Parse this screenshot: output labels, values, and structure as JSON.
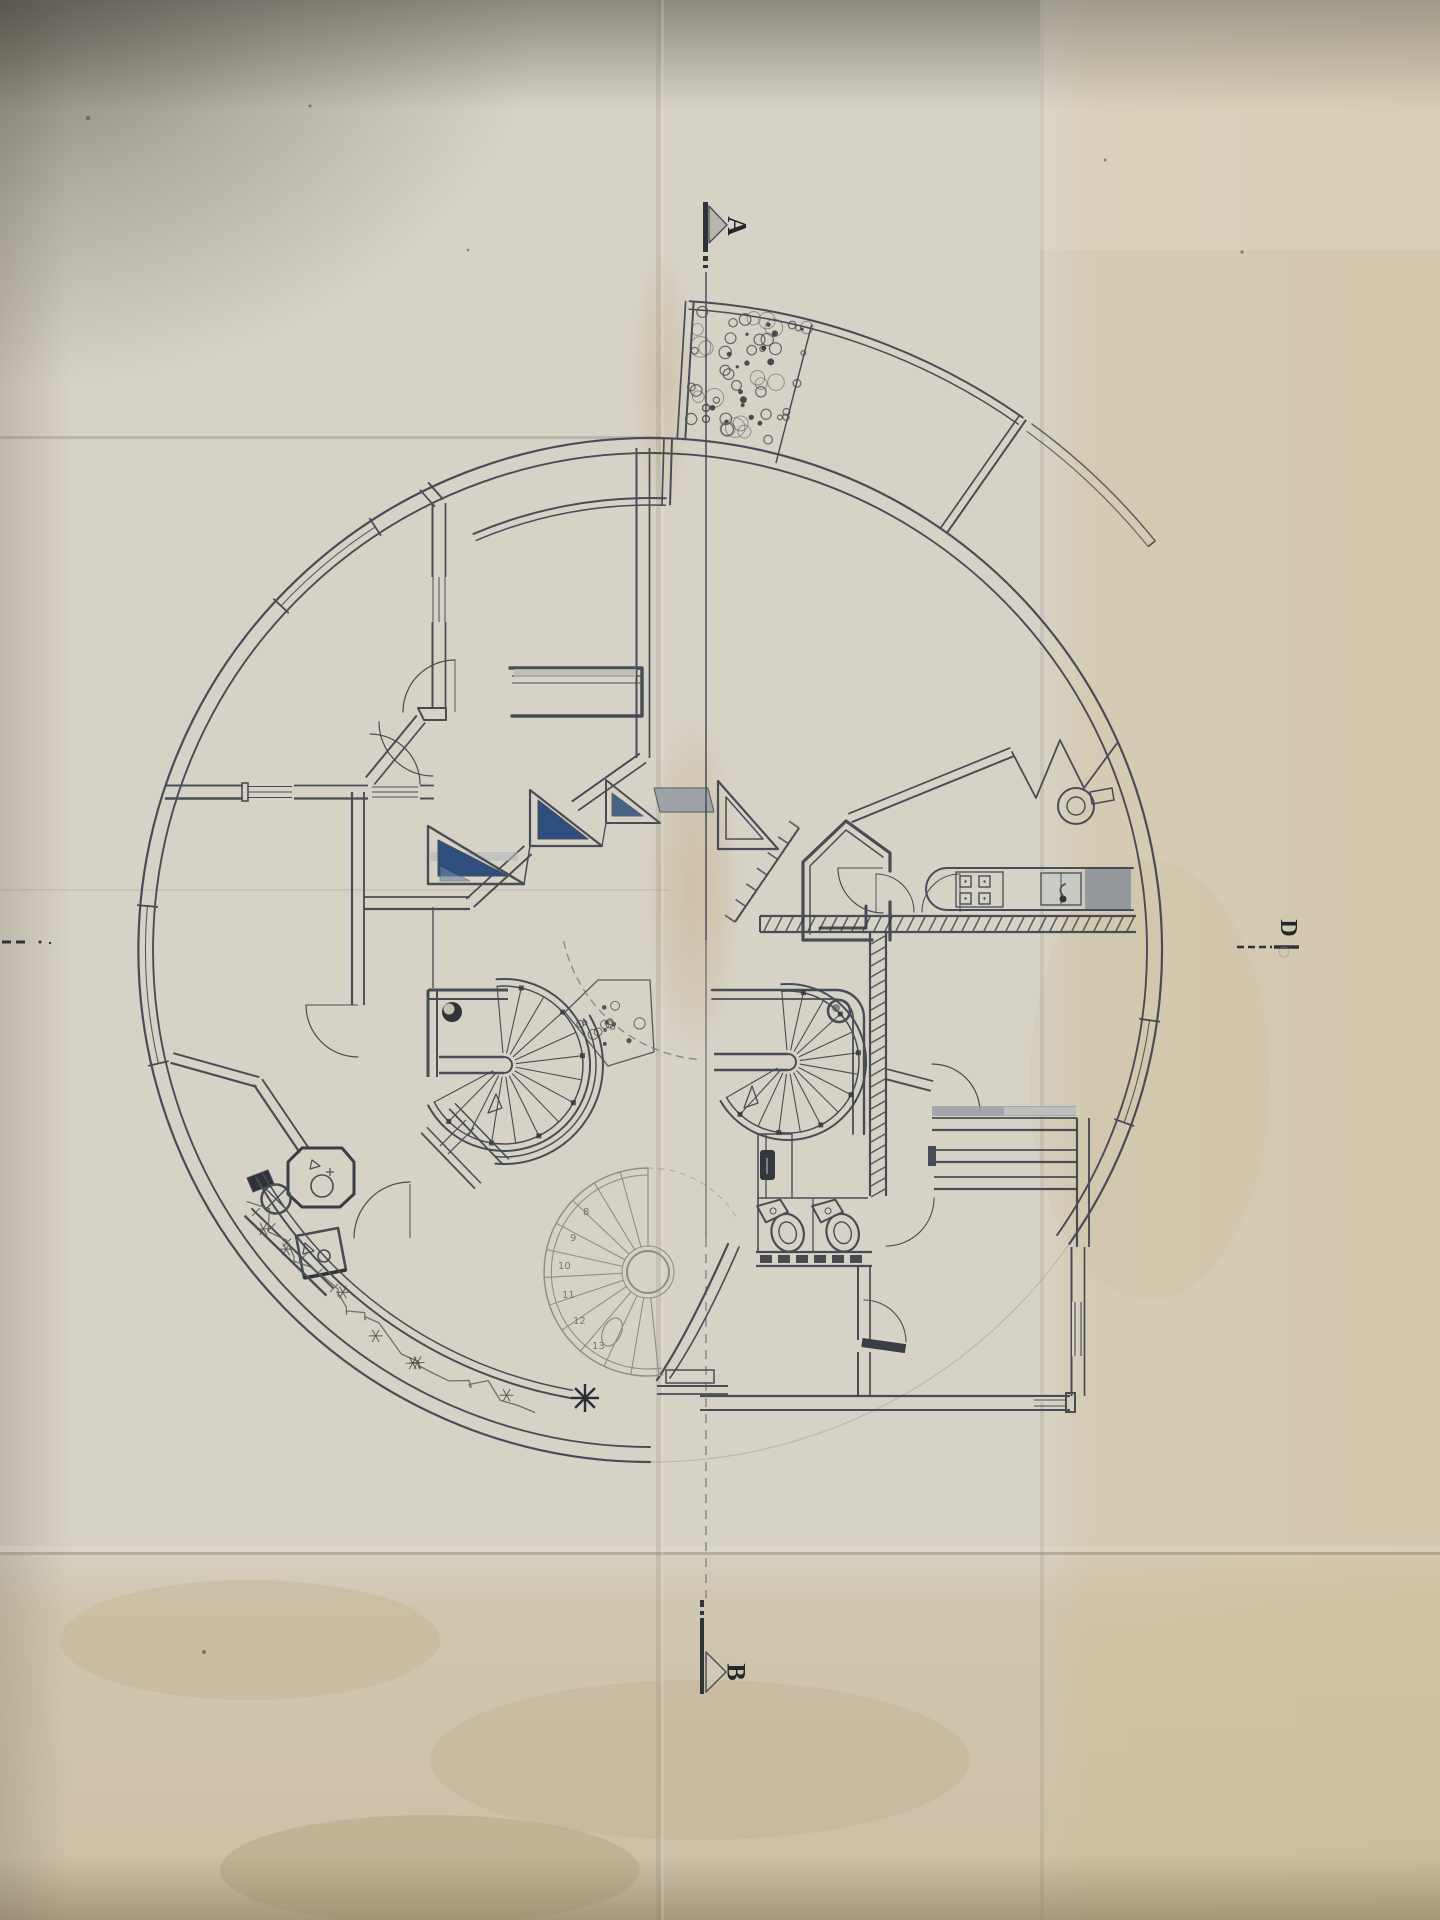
{
  "section_markers": {
    "a": "A",
    "b": "B",
    "d": "D"
  },
  "lower_stair_step_numbers": [
    "8",
    "9",
    "10",
    "11",
    "12",
    "13"
  ],
  "colors": {
    "paper": "#d7d2c6",
    "paper_warm": "#d6c9ab",
    "paper_shadow": "#5a564c",
    "ink": "#484d55",
    "ink_dark": "#2f3339",
    "pencil": "#8e8e8a",
    "glazing_blue": "#2e4f7d",
    "glazing_blue_light": "#6d86ad",
    "shade_gray": "#9aa0a8"
  }
}
